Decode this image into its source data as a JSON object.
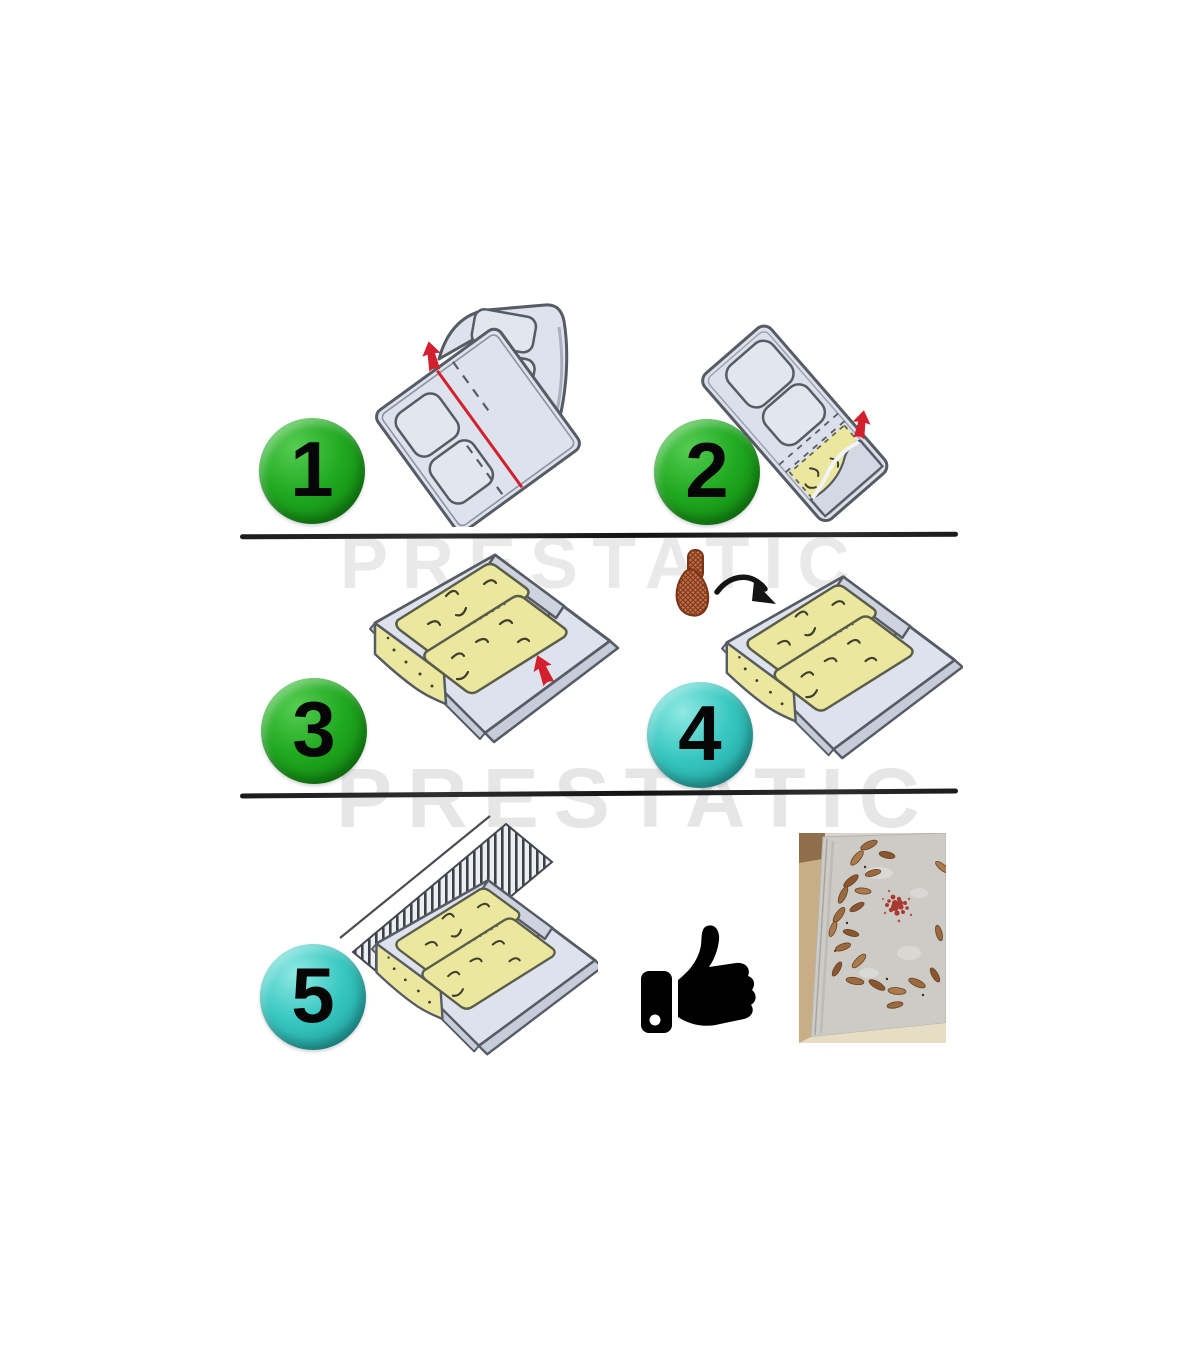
{
  "page": {
    "background_color": "#ffffff",
    "type": "glue-trap-assembly-instruction-sheet"
  },
  "watermarks": [
    {
      "text": "PRESTATIC"
    },
    {
      "text": "PRESTATIC"
    }
  ],
  "steps": [
    {
      "number": "1",
      "badge_color": "#21a921",
      "illustration": "unfolded-sheet-with-cut-line-and-lift-arrow"
    },
    {
      "number": "2",
      "badge_color": "#21a921",
      "illustration": "peel-protective-film-revealing-glue"
    },
    {
      "number": "3",
      "badge_color": "#21a921",
      "illustration": "folded-trap-with-glue-strips"
    },
    {
      "number": "4",
      "badge_color": "#38c8c1",
      "illustration": "bait-pellet-added-to-trap"
    },
    {
      "number": "5",
      "badge_color": "#38c8c1",
      "illustration": "trap-placed-against-wall"
    }
  ],
  "icons": [
    {
      "name": "red-arrow-icon",
      "color": "#d2202f"
    },
    {
      "name": "bait-pellet-icon",
      "color": "#c0714a"
    },
    {
      "name": "thumbs-up-icon",
      "color": "#000000"
    },
    {
      "name": "result-photo-cockroaches-on-glue-board",
      "color": "#cdcbc6"
    }
  ],
  "colors": {
    "badge_green": "#21a921",
    "badge_cyan": "#38c8c1",
    "accent_red": "#d2202f",
    "glue_yellow": "#ece79f",
    "trap_gray": "#dde2ec",
    "outline_gray": "#565b64",
    "divider_black": "#1b1b1b",
    "watermark_gray": "#e9e9e9"
  }
}
